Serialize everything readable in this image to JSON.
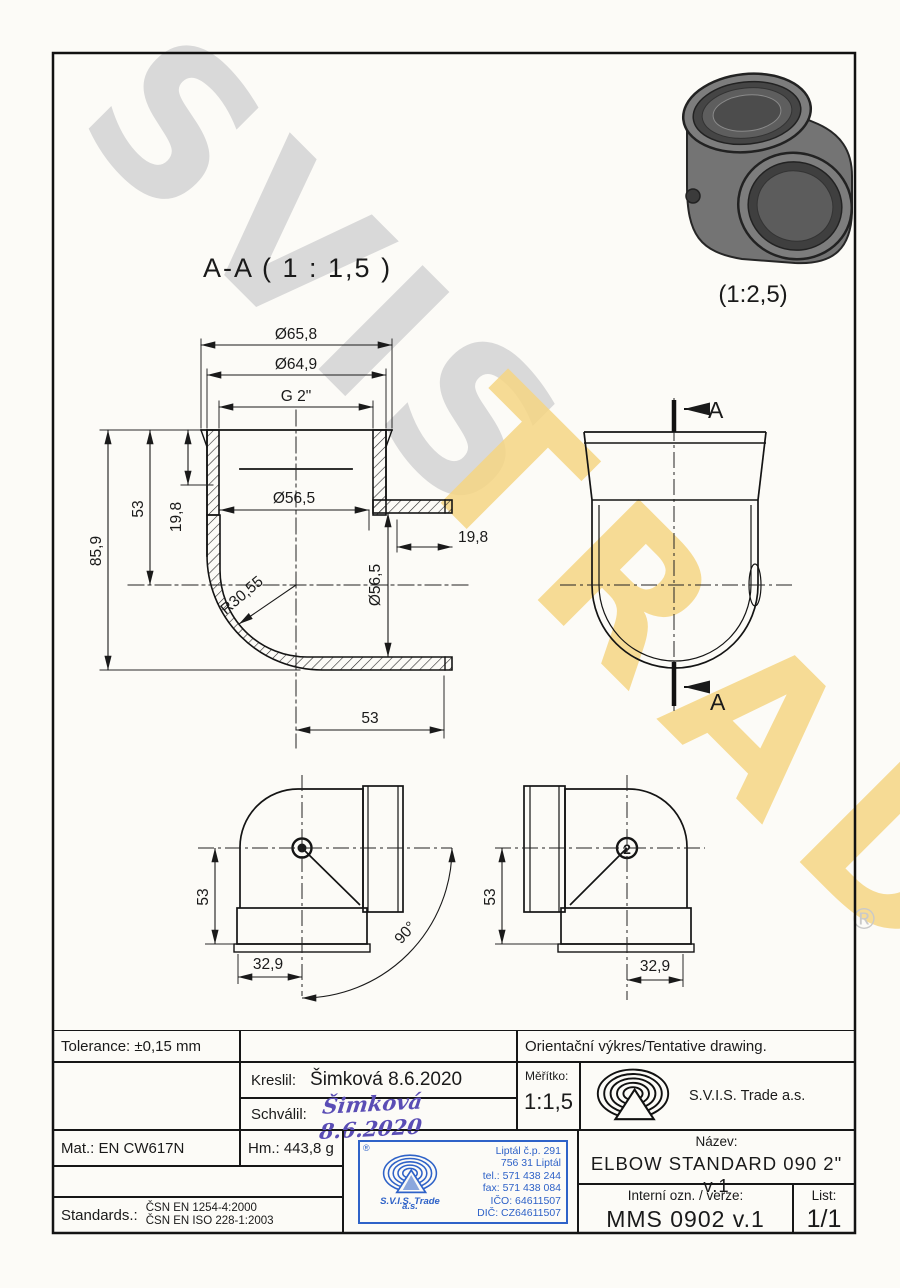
{
  "watermark": {
    "word1": "SVIS",
    "word2": "TRADE",
    "registered": "®"
  },
  "views": {
    "section_title": "A-A ( 1 : 1,5 )",
    "photo_scale": "(1:2,5)",
    "cut_mark_top": "A",
    "cut_mark_bottom": "A",
    "balloon2": "2"
  },
  "dims": {
    "dia_outer": "Ø65,8",
    "dia_mid": "Ø64,9",
    "thread": "G 2\"",
    "total_height": "85,9",
    "height_53": "53",
    "socket_depth": "19,8",
    "bore_top": "Ø56,5",
    "bore_side": "Ø56,5",
    "socket_depth_right": "19,8",
    "inner_radius": "R30,55",
    "width_53": "53",
    "tv_left_53": "53",
    "tv_left_329": "32,9",
    "tv_angle": "90°",
    "tv_right_53": "53",
    "tv_right_329": "32,9"
  },
  "titleblock": {
    "tolerance": "Tolerance: ±0,15 mm",
    "orientacni": "Orientační výkres/Tentative drawing.",
    "kreslil_label": "Kreslil:",
    "kreslil_value": "Šimková 8.6.2020",
    "schvalil_label": "Schválil:",
    "schvalil_value": "Šimková 8.6.2020",
    "meritko_label": "Měřítko:",
    "meritko_value": "1:1,5",
    "company": "S.V.I.S. Trade a.s.",
    "mat": "Mat.: EN CW617N",
    "hm": "Hm.: 443,8 g",
    "nazev_label": "Název:",
    "nazev_value": "ELBOW STANDARD 090 2\" v.1",
    "interni_label": "Interní ozn. / verze:",
    "interni_value": "MMS 0902 v.1",
    "list_label": "List:",
    "list_value": "1/1",
    "standards_label": "Standards.:",
    "standards_line1": "ČSN EN 1254-4:2000",
    "standards_line2": "ČSN EN ISO 228-1:2003",
    "stamp": {
      "registered": "®",
      "company": "S.V.I.S. Trade",
      "as": "a.s.",
      "address1": "Liptál č.p. 291",
      "address2": "756 31 Liptál",
      "tel": "tel.: 571 438 244",
      "fax": "fax: 571 438 084",
      "ico": "IČO: 64611507",
      "dic": "DIČ: CZ64611507",
      "blue": "#2e62c8"
    }
  }
}
